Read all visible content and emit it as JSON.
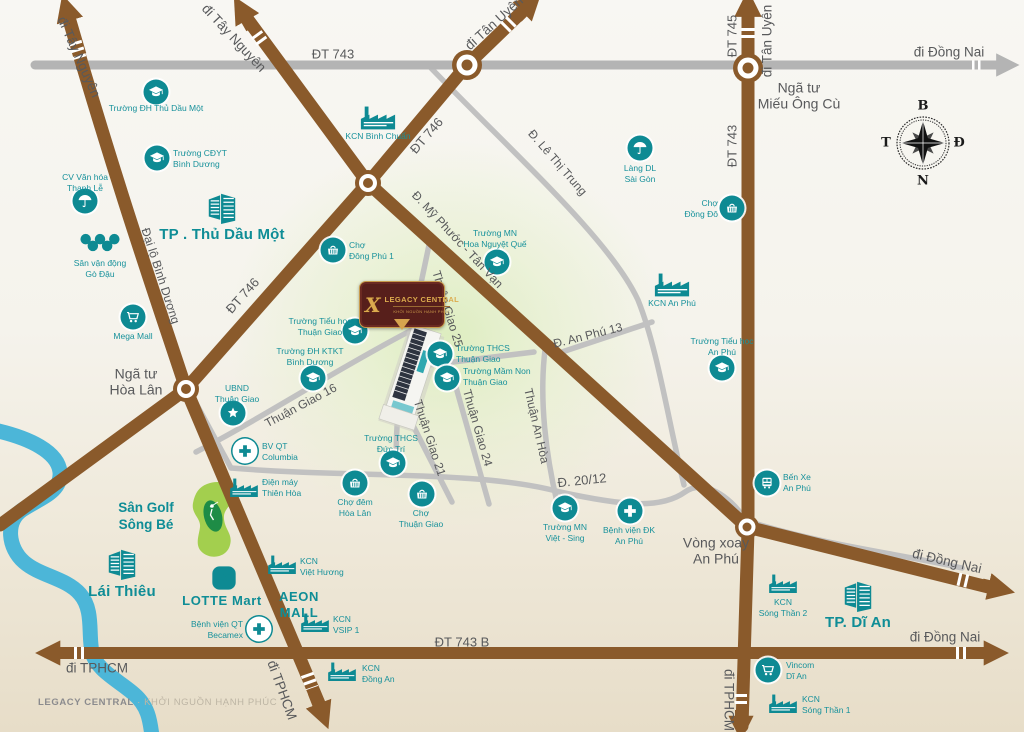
{
  "project": {
    "name": "LEGACY CENTRAL",
    "tagline": "KHỞI NGUỒN HẠNH PHÚC"
  },
  "footer": {
    "brand": "LEGACY CENTRAL",
    "sep": " · ",
    "tagline": "KHỞI NGUỒN HẠNH PHÚC"
  },
  "compass": {
    "top": "B",
    "right": "Đ",
    "bottom": "N",
    "left": "T"
  },
  "colors": {
    "road_brown": "#8a5a2b",
    "road_gray": "#b4b4b4",
    "minor_gray": "#c1c1c1",
    "teal": "#0e8a93",
    "river": "#4cb6d8",
    "golf_green": "#a3cf4e",
    "plaque_maroon": "#571f1b",
    "plaque_gold": "#dcab4e",
    "label_gray": "#58595b"
  },
  "pois": [
    {
      "id": "truong-dh-thu-dau-mot",
      "icon": "school",
      "ix": 156,
      "iy": 92,
      "lines": [
        "Trường ĐH Thủ Dầu Một"
      ],
      "lx": 156,
      "ly": 103,
      "align": "c"
    },
    {
      "id": "truong-cdyt-binh-duong",
      "icon": "school",
      "ix": 157,
      "iy": 158,
      "lines": [
        "Trường CĐYT",
        "Bình Dương"
      ],
      "lx": 173,
      "ly": 148,
      "align": "l"
    },
    {
      "id": "cv-van-hoa-thanh-le",
      "icon": "umbrella",
      "ix": 85,
      "iy": 201,
      "lines": [
        "CV Văn hóa",
        "Thanh Lễ"
      ],
      "lx": 85,
      "ly": 172,
      "align": "c"
    },
    {
      "id": "san-van-dong-go-dau",
      "icon": "rings",
      "ix": 100,
      "iy": 243,
      "lines": [
        "Sân vận động",
        "Gò Đậu"
      ],
      "lx": 100,
      "ly": 258,
      "align": "c"
    },
    {
      "id": "tp-thu-dau-mot",
      "icon": "city",
      "ix": 222,
      "iy": 207,
      "lines": [
        "TP . Thủ Dầu Một"
      ],
      "lx": 222,
      "ly": 226,
      "align": "c",
      "cls": "big"
    },
    {
      "id": "mega-mall",
      "icon": "cart",
      "ix": 133,
      "iy": 317,
      "lines": [
        "Mega Mall"
      ],
      "lx": 133,
      "ly": 331,
      "align": "c"
    },
    {
      "id": "kcn-binh-chuan",
      "icon": "factory",
      "ix": 378,
      "iy": 117,
      "lines": [
        "KCN Bình Chuẩn"
      ],
      "lx": 378,
      "ly": 131,
      "align": "c"
    },
    {
      "id": "cho-dong-phu-1",
      "icon": "market",
      "ix": 333,
      "iy": 250,
      "lines": [
        "Chợ",
        "Đông Phú 1"
      ],
      "lx": 349,
      "ly": 240,
      "align": "l"
    },
    {
      "id": "truong-mn-hoa-nguyet-que",
      "icon": "school",
      "ix": 497,
      "iy": 262,
      "lines": [
        "Trường MN",
        "Hoa Nguyệt Quế"
      ],
      "lx": 495,
      "ly": 228,
      "align": "c"
    },
    {
      "id": "lang-dl-sai-gon",
      "icon": "umbrella",
      "ix": 640,
      "iy": 148,
      "lines": [
        "Làng DL",
        "Sài Gòn"
      ],
      "lx": 640,
      "ly": 163,
      "align": "c"
    },
    {
      "id": "cho-dong-do",
      "icon": "market",
      "ix": 732,
      "iy": 208,
      "lines": [
        "Chợ",
        "Đồng Đô"
      ],
      "lx": 718,
      "ly": 198,
      "align": "r"
    },
    {
      "id": "kcn-an-phu",
      "icon": "factory",
      "ix": 672,
      "iy": 284,
      "lines": [
        "KCN An Phú"
      ],
      "lx": 672,
      "ly": 298,
      "align": "c"
    },
    {
      "id": "truong-tieu-hoc-an-phu",
      "icon": "school",
      "ix": 722,
      "iy": 368,
      "lines": [
        "Trường Tiểu học",
        "An Phú"
      ],
      "lx": 722,
      "ly": 336,
      "align": "c"
    },
    {
      "id": "truong-tieu-hoc-thuan-giao",
      "icon": "school",
      "ix": 355,
      "iy": 331,
      "lines": [
        "Trường Tiểu học",
        "Thuận Giao"
      ],
      "lx": 320,
      "ly": 316,
      "align": "c"
    },
    {
      "id": "truong-dh-ktkt-binh-duong",
      "icon": "school",
      "ix": 313,
      "iy": 378,
      "lines": [
        "Trường ĐH KTKT",
        "Bình Dương"
      ],
      "lx": 310,
      "ly": 346,
      "align": "c"
    },
    {
      "id": "ubnd-thuan-giao",
      "icon": "star",
      "ix": 233,
      "iy": 413,
      "lines": [
        "UBND",
        "Thuận Giao"
      ],
      "lx": 237,
      "ly": 383,
      "align": "c"
    },
    {
      "id": "bv-qt-columbia",
      "icon": "cross-inv",
      "ix": 245,
      "iy": 451,
      "lines": [
        "BV QT",
        "Columbia"
      ],
      "lx": 262,
      "ly": 441,
      "align": "l"
    },
    {
      "id": "dien-may-thien-hoa",
      "icon": "factory-sm",
      "ix": 244,
      "iy": 487,
      "lines": [
        "Điện máy",
        "Thiên Hòa"
      ],
      "lx": 262,
      "ly": 477,
      "align": "l"
    },
    {
      "id": "cho-dem-hoa-lan",
      "icon": "market",
      "ix": 355,
      "iy": 483,
      "lines": [
        "Chợ đêm",
        "Hòa Lân"
      ],
      "lx": 355,
      "ly": 497,
      "align": "c"
    },
    {
      "id": "cho-thuan-giao",
      "icon": "market",
      "ix": 422,
      "iy": 494,
      "lines": [
        "Chợ",
        "Thuận Giao"
      ],
      "lx": 421,
      "ly": 508,
      "align": "c"
    },
    {
      "id": "truong-thcs-duc-tri",
      "icon": "school",
      "ix": 393,
      "iy": 463,
      "lines": [
        "Trường THCS",
        "Đức Trí"
      ],
      "lx": 391,
      "ly": 433,
      "align": "c"
    },
    {
      "id": "truong-thcs-thuan-giao",
      "icon": "school",
      "ix": 440,
      "iy": 354,
      "lines": [
        "Trường THCS",
        "Thuận Giao"
      ],
      "lx": 456,
      "ly": 343,
      "align": "l"
    },
    {
      "id": "truong-mam-non-thuan-giao",
      "icon": "school",
      "ix": 447,
      "iy": 378,
      "lines": [
        "Trường Mầm Non",
        "Thuận Giao"
      ],
      "lx": 463,
      "ly": 366,
      "align": "l"
    },
    {
      "id": "truong-mn-viet-sing",
      "icon": "school",
      "ix": 565,
      "iy": 508,
      "lines": [
        "Trường MN",
        "Việt - Sing"
      ],
      "lx": 565,
      "ly": 522,
      "align": "c"
    },
    {
      "id": "benh-vien-dk-an-phu",
      "icon": "cross",
      "ix": 630,
      "iy": 511,
      "lines": [
        "Bệnh viện ĐK",
        "An Phú"
      ],
      "lx": 629,
      "ly": 525,
      "align": "c"
    },
    {
      "id": "ben-xe-an-phu",
      "icon": "bus",
      "ix": 767,
      "iy": 483,
      "lines": [
        "Bến Xe",
        "An Phú"
      ],
      "lx": 783,
      "ly": 472,
      "align": "l"
    },
    {
      "id": "san-golf-song-be",
      "lines": [
        "Sân Golf",
        "Sông Bé"
      ],
      "lx": 146,
      "ly": 500,
      "align": "c",
      "cls": "med"
    },
    {
      "id": "lai-thieu",
      "icon": "city",
      "ix": 122,
      "iy": 563,
      "lines": [
        "Lái Thiêu"
      ],
      "lx": 122,
      "ly": 583,
      "align": "c",
      "cls": "big"
    },
    {
      "id": "lotte-mart",
      "icon": "lotte",
      "ix": 224,
      "iy": 578,
      "lines": [
        "LOTTE Mart"
      ],
      "lx": 222,
      "ly": 593,
      "align": "c",
      "cls": "brand"
    },
    {
      "id": "aeon-mall",
      "lines": [
        "AEON",
        "MALL"
      ],
      "lx": 299,
      "ly": 589,
      "align": "c",
      "cls": "brand"
    },
    {
      "id": "kcn-viet-huong",
      "icon": "factory-sm",
      "ix": 282,
      "iy": 564,
      "lines": [
        "KCN",
        "Việt Hương"
      ],
      "lx": 300,
      "ly": 556,
      "align": "l"
    },
    {
      "id": "bv-qt-becamex",
      "icon": "cross-inv",
      "ix": 259,
      "iy": 629,
      "lines": [
        "Bệnh viện QT",
        "Becamex"
      ],
      "lx": 243,
      "ly": 619,
      "align": "r"
    },
    {
      "id": "kcn-vsip-1",
      "icon": "factory-sm",
      "ix": 315,
      "iy": 622,
      "lines": [
        "KCN",
        "VSIP 1"
      ],
      "lx": 333,
      "ly": 614,
      "align": "l"
    },
    {
      "id": "kcn-dong-an",
      "icon": "factory-sm",
      "ix": 342,
      "iy": 671,
      "lines": [
        "KCN",
        "Đồng An"
      ],
      "lx": 362,
      "ly": 663,
      "align": "l"
    },
    {
      "id": "kcn-song-than-2",
      "icon": "factory-sm",
      "ix": 783,
      "iy": 583,
      "lines": [
        "KCN",
        "Sóng Thần 2"
      ],
      "lx": 783,
      "ly": 597,
      "align": "c"
    },
    {
      "id": "tp-di-an",
      "icon": "city",
      "ix": 858,
      "iy": 595,
      "lines": [
        "TP. Dĩ An"
      ],
      "lx": 858,
      "ly": 614,
      "align": "c",
      "cls": "big"
    },
    {
      "id": "vincom-di-an",
      "icon": "cart",
      "ix": 768,
      "iy": 670,
      "lines": [
        "Vincom",
        "Dĩ An"
      ],
      "lx": 786,
      "ly": 660,
      "align": "l"
    },
    {
      "id": "kcn-song-than-1",
      "icon": "factory-sm",
      "ix": 783,
      "iy": 703,
      "lines": [
        "KCN",
        "Sóng Thần 1"
      ],
      "lx": 802,
      "ly": 694,
      "align": "l"
    }
  ],
  "labels": [
    {
      "id": "dt743-top",
      "lines": [
        "ĐT 743"
      ],
      "x": 333,
      "y": 55,
      "rot": 0,
      "cls": "rd"
    },
    {
      "id": "di-dong-nai-ne",
      "lines": [
        "đi Đồng Nai"
      ],
      "x": 949,
      "y": 52,
      "rot": 0,
      "cls": "dir"
    },
    {
      "id": "di-tay-nguyen-w",
      "lines": [
        "đi Tây Nguyên"
      ],
      "x": 79,
      "y": 57,
      "rot": 66,
      "cls": "dir"
    },
    {
      "id": "di-tay-nguyen-n",
      "lines": [
        "đi Tây Nguyên"
      ],
      "x": 234,
      "y": 38,
      "rot": 47,
      "cls": "dir"
    },
    {
      "id": "di-tan-uyen-n",
      "lines": [
        "đi Tân Uyên"
      ],
      "x": 494,
      "y": 23,
      "rot": -42,
      "cls": "dir"
    },
    {
      "id": "dt746-n",
      "lines": [
        "ĐT 746"
      ],
      "x": 427,
      "y": 136,
      "rot": -49,
      "cls": "rd"
    },
    {
      "id": "dt745",
      "lines": [
        "ĐT 745"
      ],
      "x": 733,
      "y": 36,
      "rot": -90,
      "cls": "rd"
    },
    {
      "id": "di-tan-uyen-e",
      "lines": [
        "đi Tân Uyên"
      ],
      "x": 767,
      "y": 41,
      "rot": -90,
      "cls": "dir"
    },
    {
      "id": "nga-tu-mieu-ong-cu",
      "lines": [
        "Ngã tư",
        "Miếu Ông Cù"
      ],
      "x": 799,
      "y": 96,
      "rot": 0,
      "cls": "place"
    },
    {
      "id": "dt743-e",
      "lines": [
        "ĐT 743"
      ],
      "x": 733,
      "y": 146,
      "rot": -90,
      "cls": "rd"
    },
    {
      "id": "d-le-thi-trung",
      "lines": [
        "Đ. Lê Thị Trung"
      ],
      "x": 557,
      "y": 163,
      "rot": 49,
      "cls": "rd2"
    },
    {
      "id": "d-my-phuoc-tan-van",
      "lines": [
        "Đ. Mỹ Phước - Tân Vạn"
      ],
      "x": 457,
      "y": 240,
      "rot": 47,
      "cls": "rd2"
    },
    {
      "id": "thuan-giao-25",
      "lines": [
        "Thuận Giao 25"
      ],
      "x": 447,
      "y": 309,
      "rot": 73,
      "cls": "rd2"
    },
    {
      "id": "dai-lo-binh-duong",
      "lines": [
        "Đại lộ Bình Dương"
      ],
      "x": 160,
      "y": 276,
      "rot": 72,
      "cls": "rd2"
    },
    {
      "id": "dt746-s",
      "lines": [
        "ĐT 746"
      ],
      "x": 243,
      "y": 296,
      "rot": -48,
      "cls": "rd"
    },
    {
      "id": "nga-tu-hoa-lan",
      "lines": [
        "Ngã tư",
        "Hòa Lân"
      ],
      "x": 136,
      "y": 382,
      "rot": 0,
      "cls": "place"
    },
    {
      "id": "thuan-giao-16",
      "lines": [
        "Thuận Giao 16"
      ],
      "x": 301,
      "y": 406,
      "rot": -28,
      "cls": "rd2"
    },
    {
      "id": "thuan-giao-21",
      "lines": [
        "Thuận Giao 21"
      ],
      "x": 429,
      "y": 438,
      "rot": 72,
      "cls": "rd2"
    },
    {
      "id": "thuan-giao-24",
      "lines": [
        "Thuận Giao 24"
      ],
      "x": 477,
      "y": 428,
      "rot": 74,
      "cls": "rd2"
    },
    {
      "id": "thuan-an-hoa",
      "lines": [
        "Thuận An Hòa"
      ],
      "x": 536,
      "y": 426,
      "rot": 77,
      "cls": "rd2"
    },
    {
      "id": "d-an-phu-13",
      "lines": [
        "Đ. An Phú 13"
      ],
      "x": 588,
      "y": 336,
      "rot": -14,
      "cls": "rd2"
    },
    {
      "id": "d-20-12",
      "lines": [
        "Đ. 20/12"
      ],
      "x": 582,
      "y": 481,
      "rot": -6,
      "cls": "rd"
    },
    {
      "id": "vong-xoay-an-phu",
      "lines": [
        "Vòng xoay",
        "An Phú"
      ],
      "x": 716,
      "y": 551,
      "rot": 0,
      "cls": "place"
    },
    {
      "id": "di-dong-nai-se",
      "lines": [
        "đi Đồng Nai"
      ],
      "x": 947,
      "y": 561,
      "rot": 13,
      "cls": "dir"
    },
    {
      "id": "di-dong-nai-e",
      "lines": [
        "đi Đồng Nai"
      ],
      "x": 945,
      "y": 637,
      "rot": 0,
      "cls": "dir"
    },
    {
      "id": "dt743b",
      "lines": [
        "ĐT 743 B"
      ],
      "x": 462,
      "y": 643,
      "rot": 0,
      "cls": "rd"
    },
    {
      "id": "di-tphcm-w",
      "lines": [
        "đi TPHCM"
      ],
      "x": 97,
      "y": 668,
      "rot": 0,
      "cls": "dir"
    },
    {
      "id": "di-tphcm-s",
      "lines": [
        "đi TPHCM"
      ],
      "x": 282,
      "y": 690,
      "rot": 70,
      "cls": "dir"
    },
    {
      "id": "di-tphcm-se",
      "lines": [
        "đi TPHCM"
      ],
      "x": 729,
      "y": 700,
      "rot": 90,
      "cls": "dir"
    }
  ]
}
